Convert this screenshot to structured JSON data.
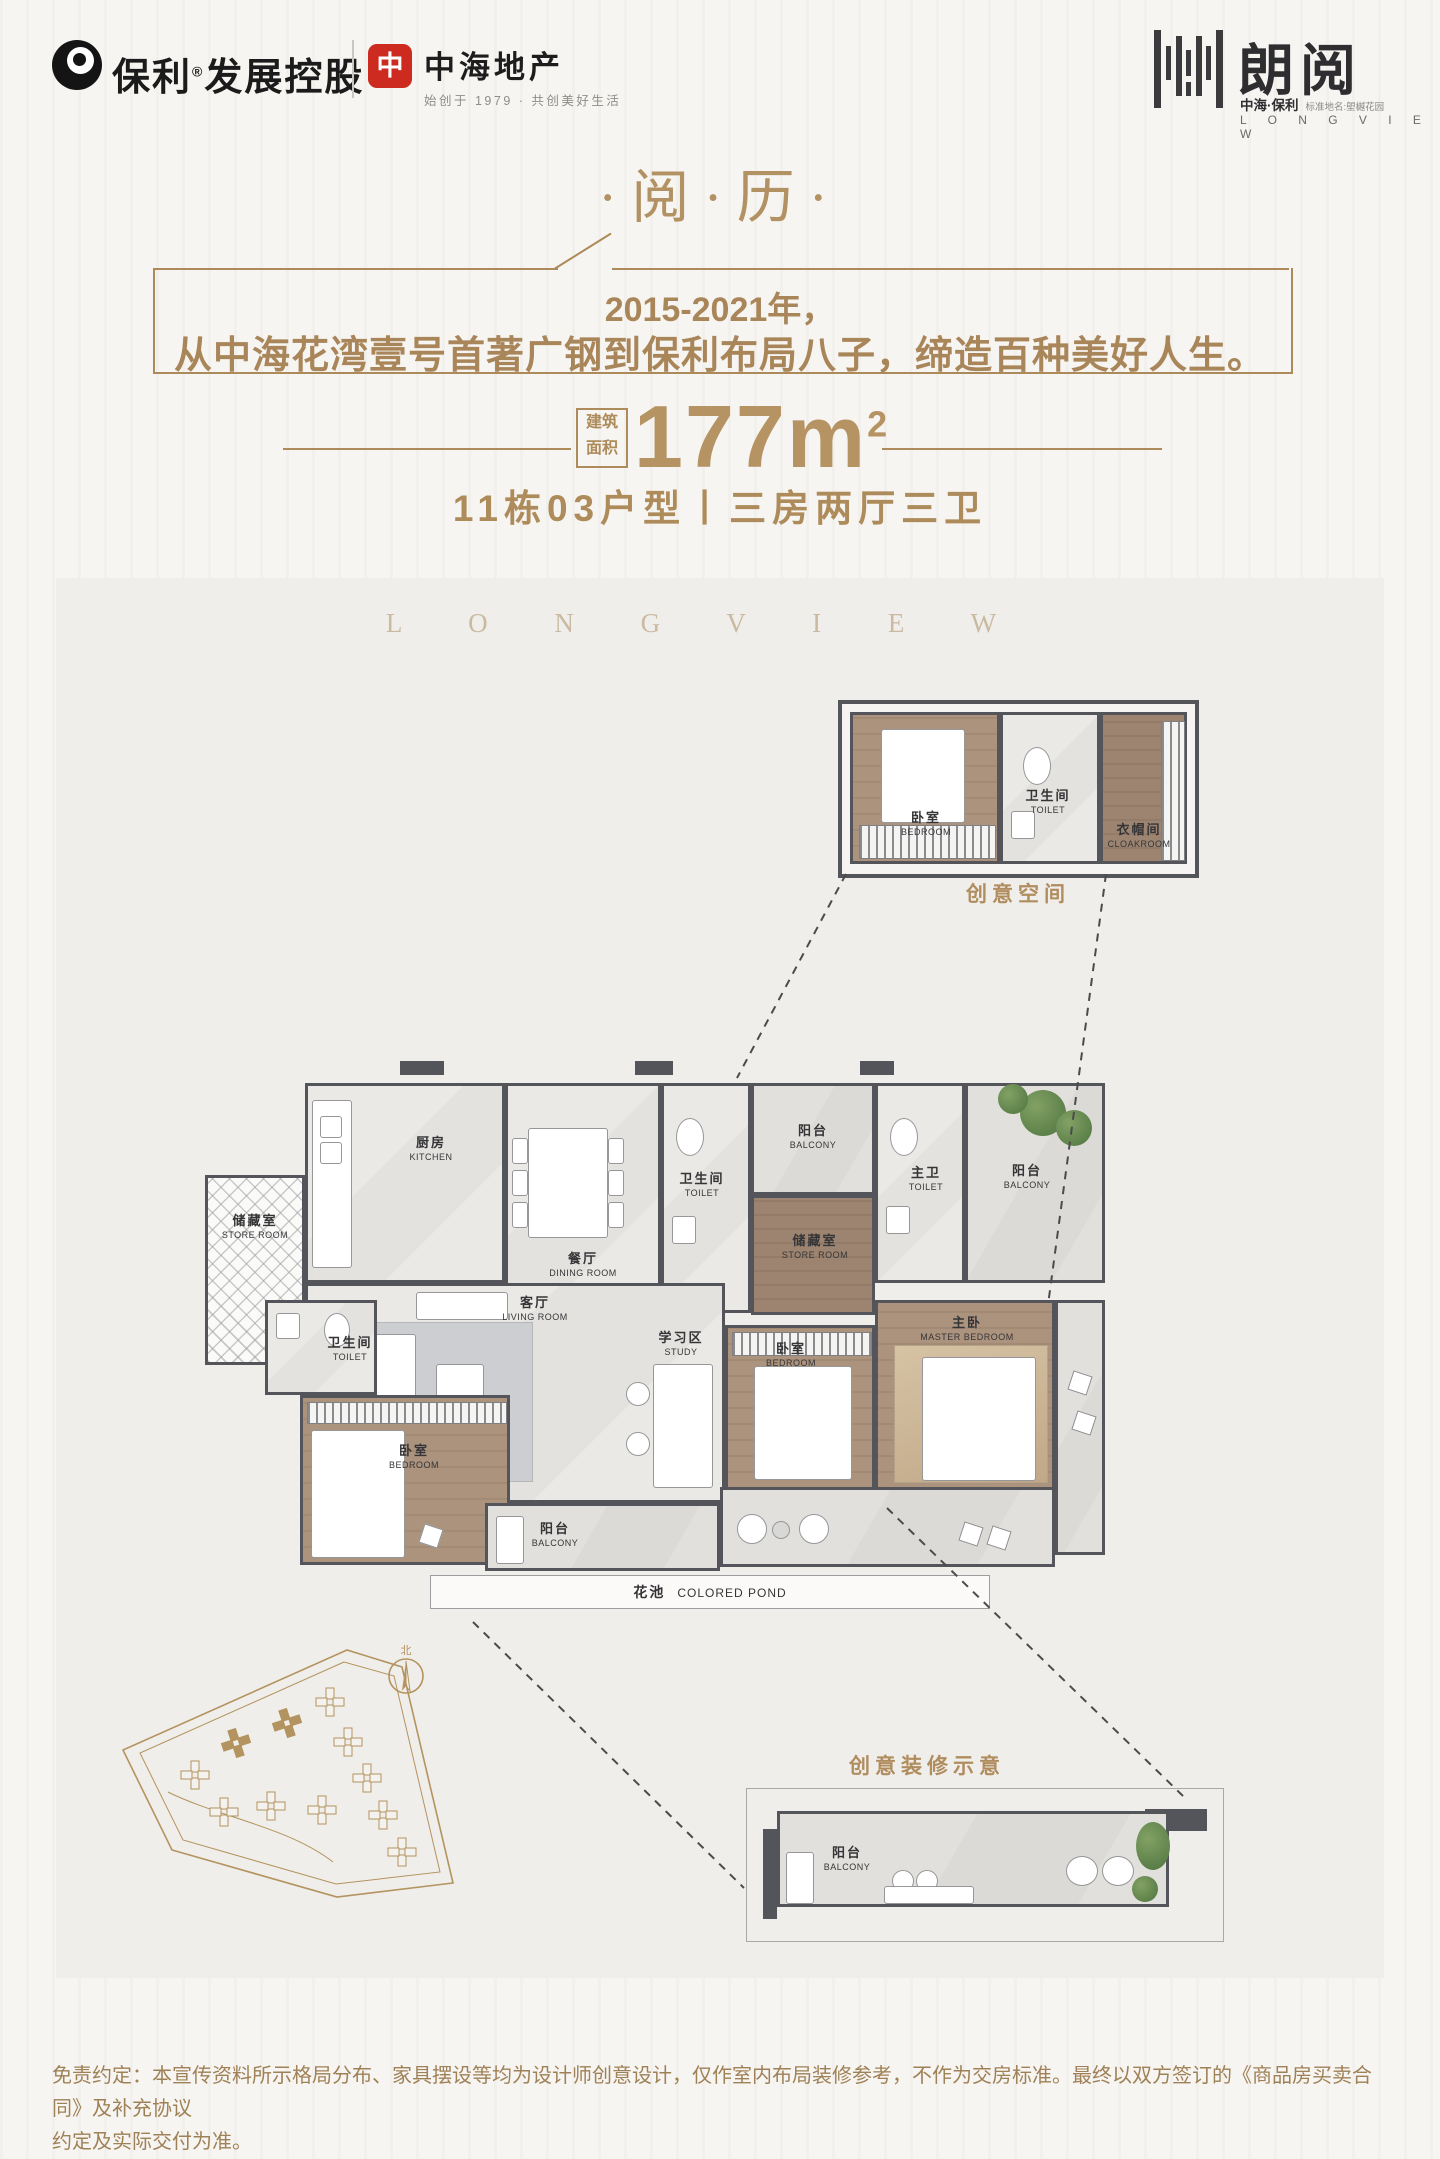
{
  "header": {
    "poly": {
      "brand": "保利",
      "reg": "®",
      "suffix": "发展控股"
    },
    "zhonghai": {
      "logo_glyph": "中",
      "name": "中海地产",
      "tagline": "始创于 1979 · 共创美好生活"
    },
    "longview": {
      "name": "朗阅",
      "sub_brand": "中海·保利",
      "sub_note": "标准地名:塱樾花园",
      "latin": "L O N G V I E W"
    }
  },
  "hero": {
    "title": "·阅·历·",
    "line1": "2015-2021年，",
    "line2": "从中海花湾壹号首著广钢到保利布局八子，缔造百种美好人生。",
    "area_stamp_top": "建筑",
    "area_stamp_bottom": "面积",
    "area_value": "177m",
    "area_sup": "2",
    "unit_line": "11栋03户型丨三房两厅三卫"
  },
  "plan": {
    "watermark": "L O N G V I E W",
    "captions": {
      "inset_top": "创意空间",
      "inset_bottom": "创意装修示意"
    },
    "compass_label": "北",
    "rooms": {
      "store_left": {
        "cn": "储藏室",
        "en": "STORE ROOM"
      },
      "kitchen": {
        "cn": "厨房",
        "en": "KITCHEN"
      },
      "dining": {
        "cn": "餐厅",
        "en": "DINING ROOM"
      },
      "toilet_mid": {
        "cn": "卫生间",
        "en": "TOILET"
      },
      "balcony_top": {
        "cn": "阳台",
        "en": "BALCONY"
      },
      "store_mid": {
        "cn": "储藏室",
        "en": "STORE ROOM"
      },
      "toilet_master": {
        "cn": "主卫",
        "en": "TOILET"
      },
      "balcony_right": {
        "cn": "阳台",
        "en": "BALCONY"
      },
      "living": {
        "cn": "客厅",
        "en": "LIVING ROOM"
      },
      "study": {
        "cn": "学习区",
        "en": "STUDY"
      },
      "bedroom_mid": {
        "cn": "卧室",
        "en": "BEDROOM"
      },
      "master": {
        "cn": "主卧",
        "en": "MASTER BEDROOM"
      },
      "toilet_left": {
        "cn": "卫生间",
        "en": "TOILET"
      },
      "bedroom_left": {
        "cn": "卧室",
        "en": "BEDROOM"
      },
      "balcony_bottom": {
        "cn": "阳台",
        "en": "BALCONY"
      },
      "pond": {
        "cn": "花池",
        "en": "COLORED POND"
      }
    },
    "inset_top_rooms": {
      "bedroom": {
        "cn": "卧室",
        "en": "BEDROOM"
      },
      "toilet": {
        "cn": "卫生间",
        "en": "TOILET"
      },
      "cloakroom": {
        "cn": "衣帽间",
        "en": "CLOAKROOM"
      }
    },
    "inset_bottom_rooms": {
      "balcony": {
        "cn": "阳台",
        "en": "BALCONY"
      }
    }
  },
  "colors": {
    "accent_gold": "#ae8b5a",
    "title_gold": "#b29263",
    "logo_red": "#cd2a20",
    "wall_gray": "#54555a",
    "wood_floor": "#ac937e",
    "marble_floor": "#e9e7e4",
    "panel_bg": "#f0eeea"
  },
  "disclaimer": {
    "line1": "免责约定：本宣传资料所示格局分布、家具摆设等均为设计师创意设计，仅作室内布局装修参考，不作为交房标准。最终以双方签订的《商品房买卖合同》及补充协议",
    "line2": "约定及实际交付为准。"
  }
}
